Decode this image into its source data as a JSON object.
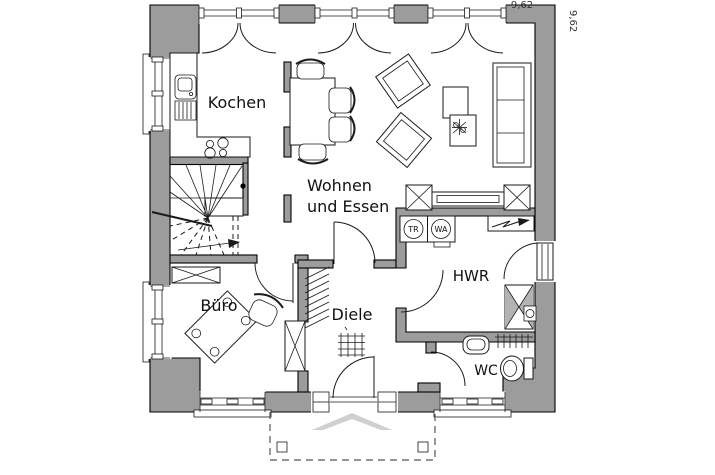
{
  "plan_title": "Erdgeschoss Grundriss",
  "dimensions": {
    "top": "9,62",
    "right": "9,62"
  },
  "rooms": {
    "kochen": {
      "label": "Kochen"
    },
    "wohnen_essen": {
      "label_line1": "Wohnen",
      "label_line2": "und Essen"
    },
    "buero": {
      "label": "Büro"
    },
    "diele": {
      "label": "Diele"
    },
    "hwr": {
      "label": "HWR"
    },
    "wc": {
      "label": "WC"
    }
  },
  "appliances": {
    "dryer_label": "TR",
    "washer_label": "WA"
  },
  "colors": {
    "wall": "#9c9c9c",
    "line": "#1a1a1a",
    "canopy": "#cfcfcf",
    "floor": "#ffffff"
  }
}
